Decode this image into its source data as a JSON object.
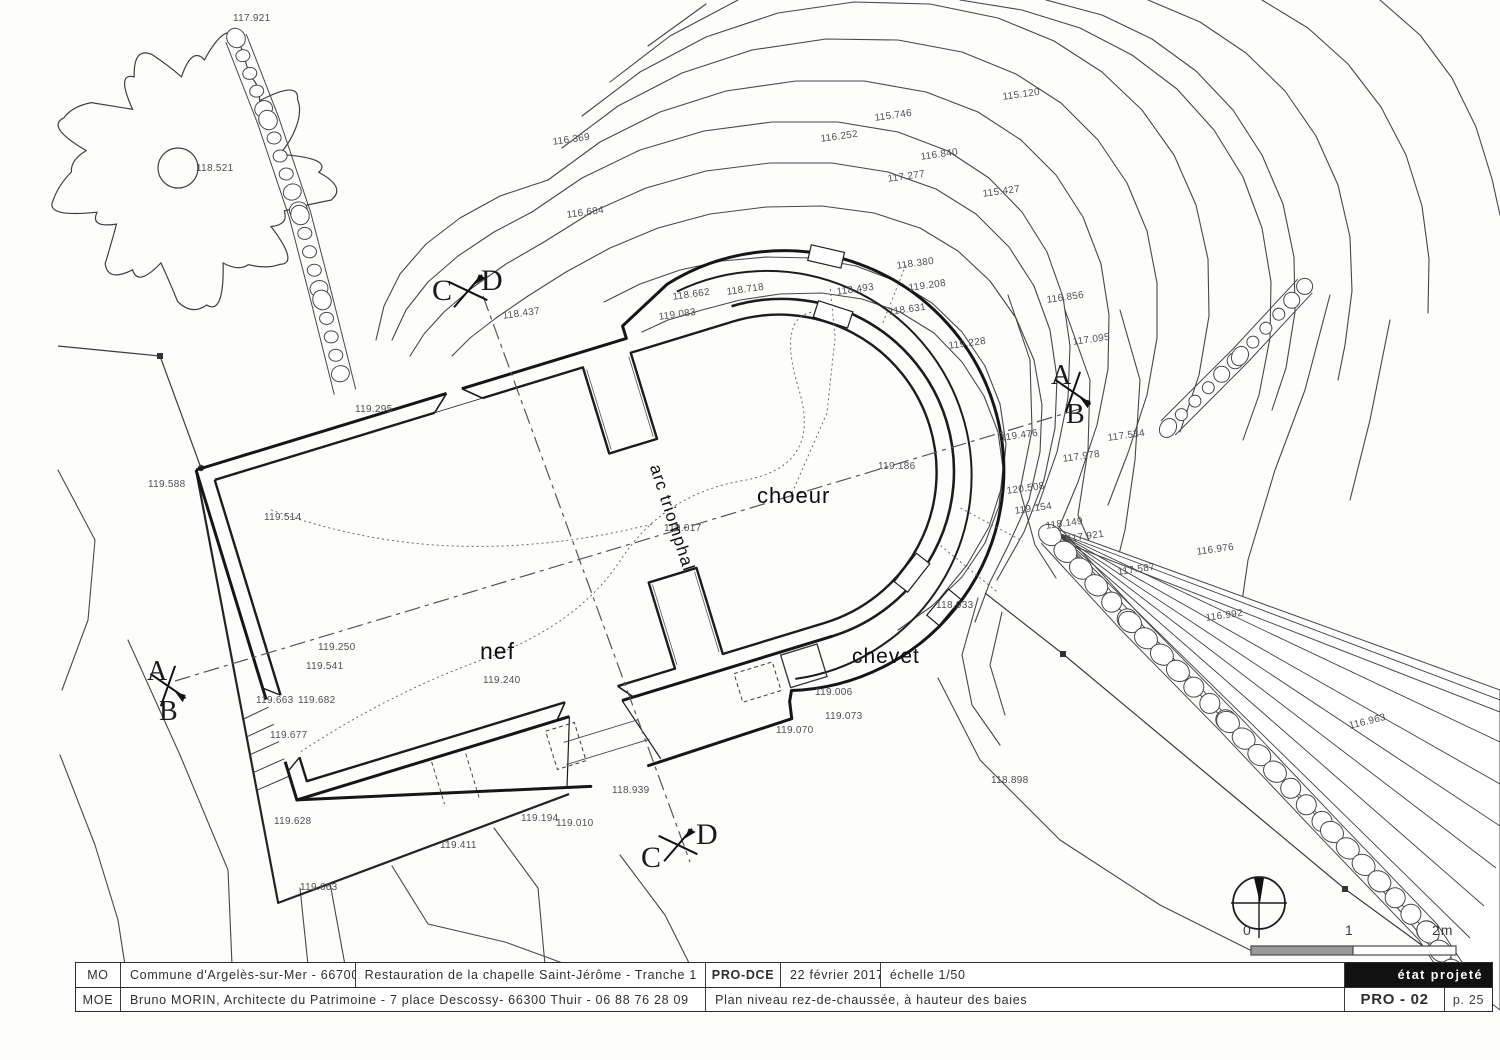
{
  "title_block": {
    "row1": {
      "mo_label": "MO",
      "mo_value": "Commune d'Argelès-sur-Mer - 66700",
      "project": "Restauration de la chapelle Saint-Jérôme - Tranche 1",
      "phase": "PRO-DCE",
      "date": "22 février 2017",
      "scale": "échelle 1/50",
      "status": "état projeté"
    },
    "row2": {
      "moe_label": "MOE",
      "moe_value": "Bruno MORIN, Architecte du Patrimoine - 7 place Descossy- 66300 Thuir - 06 88 76 28 09",
      "sheet_title": "Plan niveau rez-de-chaussée, à hauteur des baies",
      "sheet_number": "PRO - 02",
      "page": "p. 25"
    }
  },
  "plan": {
    "room_labels": [
      {
        "text": "nef",
        "x": 480,
        "y": 638,
        "size": 23,
        "rot": 0
      },
      {
        "text": "choeur",
        "x": 757,
        "y": 483,
        "size": 22,
        "rot": 0
      },
      {
        "text": "chevet",
        "x": 852,
        "y": 645,
        "size": 21,
        "rot": 0
      },
      {
        "text": "arc triomphal",
        "x": 664,
        "y": 462,
        "size": 17,
        "rot": 72
      }
    ],
    "section_letters": [
      {
        "t": "C",
        "x": 432,
        "y": 274,
        "s": 30
      },
      {
        "t": "D",
        "x": 481,
        "y": 264,
        "s": 30
      },
      {
        "t": "C",
        "x": 641,
        "y": 841,
        "s": 30
      },
      {
        "t": "D",
        "x": 696,
        "y": 818,
        "s": 30
      },
      {
        "t": "A",
        "x": 147,
        "y": 656,
        "s": 28
      },
      {
        "t": "B",
        "x": 159,
        "y": 696,
        "s": 28
      },
      {
        "t": "A",
        "x": 1051,
        "y": 360,
        "s": 28
      },
      {
        "t": "B",
        "x": 1066,
        "y": 399,
        "s": 28
      }
    ],
    "spot_elevations": [
      {
        "v": "117.921",
        "x": 233,
        "y": 13,
        "r": 0
      },
      {
        "v": "118.521",
        "x": 196,
        "y": 163,
        "r": 0
      },
      {
        "v": "115.120",
        "x": 1002,
        "y": 92,
        "r": -8
      },
      {
        "v": "115.746",
        "x": 874,
        "y": 113,
        "r": -8
      },
      {
        "v": "116.252",
        "x": 820,
        "y": 134,
        "r": -8
      },
      {
        "v": "116.840",
        "x": 920,
        "y": 152,
        "r": -8
      },
      {
        "v": "117.277",
        "x": 887,
        "y": 174,
        "r": -8
      },
      {
        "v": "115.427",
        "x": 982,
        "y": 189,
        "r": -8
      },
      {
        "v": "116.369",
        "x": 552,
        "y": 137,
        "r": -8
      },
      {
        "v": "116.684",
        "x": 566,
        "y": 210,
        "r": -8
      },
      {
        "v": "118.380",
        "x": 896,
        "y": 261,
        "r": -8
      },
      {
        "v": "118.718",
        "x": 726,
        "y": 287,
        "r": -8
      },
      {
        "v": "118.662",
        "x": 672,
        "y": 292,
        "r": -8
      },
      {
        "v": "118.493",
        "x": 836,
        "y": 287,
        "r": -8
      },
      {
        "v": "119.208",
        "x": 908,
        "y": 283,
        "r": -8
      },
      {
        "v": "116.856",
        "x": 1046,
        "y": 295,
        "r": -8
      },
      {
        "v": "119.083",
        "x": 658,
        "y": 312,
        "r": -8
      },
      {
        "v": "118.437",
        "x": 502,
        "y": 311,
        "r": -8
      },
      {
        "v": "117.095",
        "x": 1072,
        "y": 337,
        "r": -8
      },
      {
        "v": "118.631",
        "x": 888,
        "y": 307,
        "r": -8
      },
      {
        "v": "119.228",
        "x": 948,
        "y": 341,
        "r": -8
      },
      {
        "v": "119.295",
        "x": 355,
        "y": 404,
        "r": 0
      },
      {
        "v": "117.534",
        "x": 1107,
        "y": 433,
        "r": -8
      },
      {
        "v": "119.476",
        "x": 1000,
        "y": 433,
        "r": -8
      },
      {
        "v": "117.978",
        "x": 1062,
        "y": 454,
        "r": -8
      },
      {
        "v": "119.186",
        "x": 878,
        "y": 461,
        "r": 0
      },
      {
        "v": "120.508",
        "x": 1006,
        "y": 486,
        "r": -8
      },
      {
        "v": "119.154",
        "x": 1014,
        "y": 506,
        "r": -8
      },
      {
        "v": "118.149",
        "x": 1045,
        "y": 521,
        "r": -8
      },
      {
        "v": "117.921",
        "x": 1066,
        "y": 534,
        "r": -8
      },
      {
        "v": "116.976",
        "x": 1196,
        "y": 547,
        "r": -8
      },
      {
        "v": "117.587",
        "x": 1117,
        "y": 567,
        "r": -8
      },
      {
        "v": "116.992",
        "x": 1205,
        "y": 613,
        "r": -8
      },
      {
        "v": "118.933",
        "x": 936,
        "y": 600,
        "r": 0
      },
      {
        "v": "119.514",
        "x": 264,
        "y": 512,
        "r": 0
      },
      {
        "v": "119.588",
        "x": 148,
        "y": 479,
        "r": 0
      },
      {
        "v": "119.250",
        "x": 318,
        "y": 642,
        "r": 0
      },
      {
        "v": "119.541",
        "x": 306,
        "y": 661,
        "r": 0
      },
      {
        "v": "119.663",
        "x": 256,
        "y": 695,
        "r": 0
      },
      {
        "v": "119.682",
        "x": 298,
        "y": 695,
        "r": 0
      },
      {
        "v": "119.677",
        "x": 270,
        "y": 730,
        "r": 0
      },
      {
        "v": "119.240",
        "x": 483,
        "y": 675,
        "r": 0
      },
      {
        "v": "119.017",
        "x": 664,
        "y": 523,
        "r": 0
      },
      {
        "v": "119.006",
        "x": 815,
        "y": 687,
        "r": 0
      },
      {
        "v": "119.073",
        "x": 825,
        "y": 711,
        "r": 0
      },
      {
        "v": "119.070",
        "x": 776,
        "y": 725,
        "r": 0
      },
      {
        "v": "118.898",
        "x": 991,
        "y": 775,
        "r": 0
      },
      {
        "v": "118.939",
        "x": 612,
        "y": 785,
        "r": 0
      },
      {
        "v": "119.194",
        "x": 521,
        "y": 813,
        "r": 0
      },
      {
        "v": "119.010",
        "x": 556,
        "y": 818,
        "r": 0
      },
      {
        "v": "119.628",
        "x": 274,
        "y": 816,
        "r": 0
      },
      {
        "v": "119.411",
        "x": 440,
        "y": 840,
        "r": 0
      },
      {
        "v": "119.663",
        "x": 300,
        "y": 882,
        "r": 0
      },
      {
        "v": "116.963",
        "x": 1348,
        "y": 721,
        "r": -14
      }
    ]
  },
  "scale_bar": {
    "t0": "0",
    "t1": "1",
    "t2": "2m"
  }
}
